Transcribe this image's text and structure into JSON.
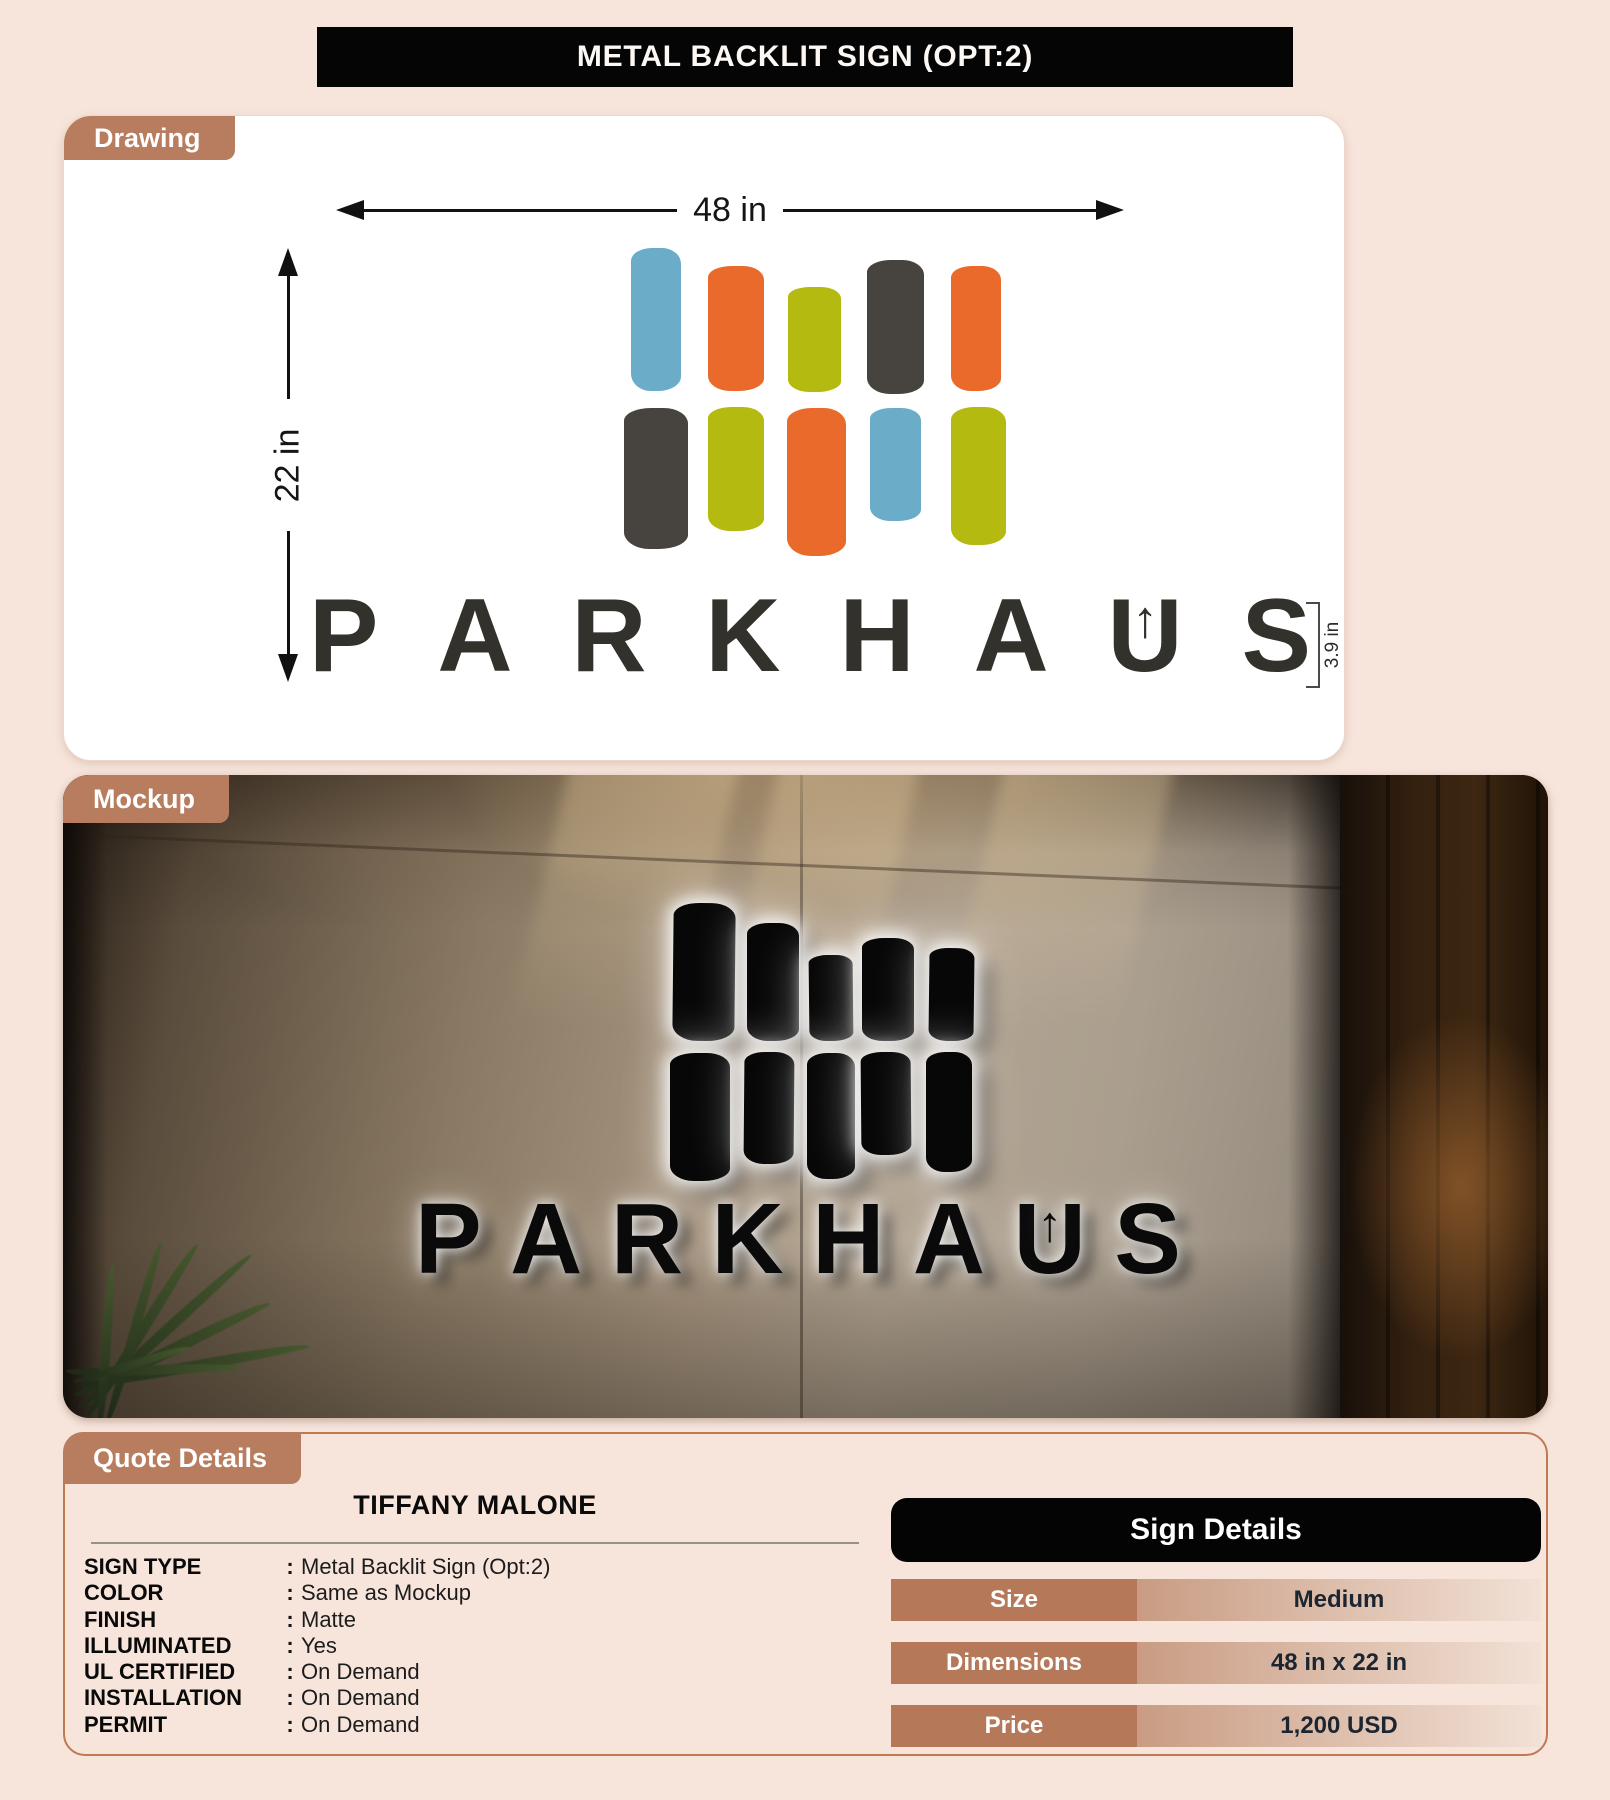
{
  "title": "METAL BACKLIT SIGN (OPT:2)",
  "tabs": {
    "drawing": "Drawing",
    "mockup": "Mockup",
    "quote": "Quote Details"
  },
  "brand": {
    "letters": [
      "P",
      "A",
      "R",
      "K",
      "H",
      "A",
      "U",
      "S"
    ],
    "arrow_letter": "U",
    "u_arrow_glyph": "↑"
  },
  "drawing": {
    "width_label": "48 in",
    "height_label": "22 in",
    "wordmark_height_label": "3.9 in",
    "bar_rows": [
      [
        "blue",
        "orange",
        "olive",
        "charcoal",
        "orange"
      ],
      [
        "charcoal",
        "olive",
        "orange",
        "blue",
        "olive"
      ]
    ]
  },
  "colors": {
    "accent_brown": "#b87c5e",
    "page_bg": "#f7e5dc",
    "title_bg": "#050505",
    "logo_blue": "#6badc9",
    "logo_orange": "#e96a2b",
    "logo_olive": "#b4ba10",
    "logo_charcoal": "#474440"
  },
  "quote": {
    "customer_name": "TIFFANY MALONE",
    "separator": ":",
    "specs": [
      {
        "label": "SIGN TYPE",
        "value": "Metal Backlit Sign (Opt:2)"
      },
      {
        "label": "COLOR",
        "value": "Same as Mockup"
      },
      {
        "label": "FINISH",
        "value": "Matte"
      },
      {
        "label": "ILLUMINATED",
        "value": "Yes"
      },
      {
        "label": "UL CERTIFIED",
        "value": "On Demand"
      },
      {
        "label": "INSTALLATION",
        "value": "On Demand"
      },
      {
        "label": "PERMIT",
        "value": "On Demand"
      }
    ]
  },
  "sign_details": {
    "title": "Sign Details",
    "rows": [
      {
        "label": "Size",
        "value": "Medium"
      },
      {
        "label": "Dimensions",
        "value": "48 in x 22 in"
      },
      {
        "label": "Price",
        "value": "1,200 USD"
      }
    ]
  }
}
